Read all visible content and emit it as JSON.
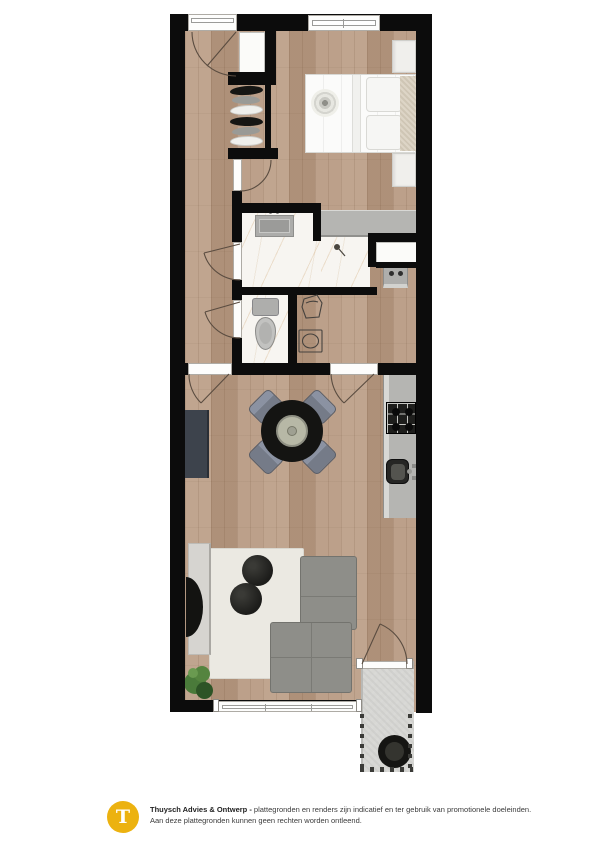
{
  "footer": {
    "logo_letter": "T",
    "brand": "Thuysch Advies & Ontwerp -",
    "disclaimer_line1": "plattegronden en renders zijn indicatief en ter gebruik van promotionele doeleinden.",
    "disclaimer_line2": "Aan deze plattegronden kunnen geen rechten worden ontleend."
  },
  "colors": {
    "wall": "#0c0c0c",
    "wood_floor": "#b79a83",
    "marble": "#f7f5f1",
    "counter_gray": "#b5b5b2",
    "concrete": "#d7d7d4",
    "rug": "#ebe9e2",
    "sofa": "#8e8e89",
    "sideboard": "#3d434c",
    "chair": "#757b88",
    "logo_gold": "#ECB210",
    "plant_green": "#4a7a3a"
  }
}
